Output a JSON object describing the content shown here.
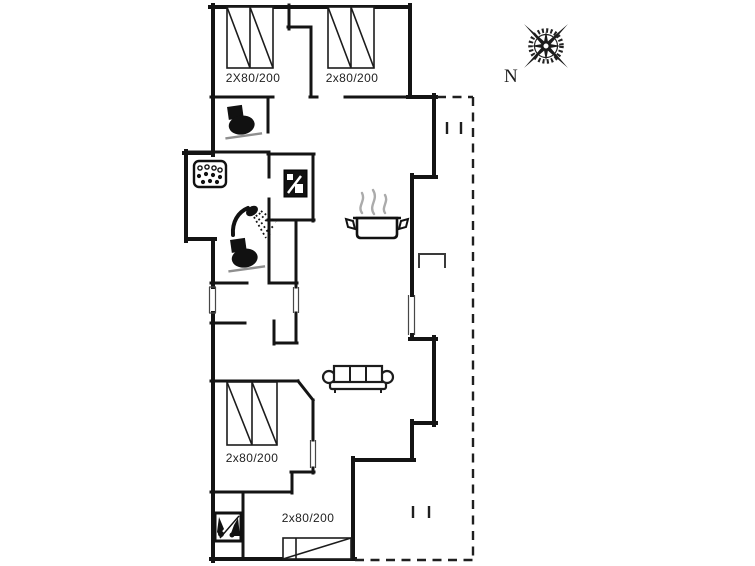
{
  "plan": {
    "type": "floor-plan",
    "bed_labels": {
      "top_left": "2X80/200",
      "top_right": "2x80/200",
      "middle": "2x80/200",
      "bottom": "2x80/200"
    },
    "compass_label": "N",
    "colors": {
      "background": "#ffffff",
      "wall": "#141414",
      "thin_line": "#474747",
      "steam_gray": "#ababab",
      "wc_base_gray": "#8f8f8f"
    },
    "icons": [
      "compass-rose-icon",
      "wc-icon",
      "shower-icon",
      "whirlpool-icon",
      "washing-machine-icon",
      "cooking-pot-icon",
      "sofa-icon",
      "sauna-icon",
      "step-icon",
      "terrace-boundary"
    ]
  }
}
